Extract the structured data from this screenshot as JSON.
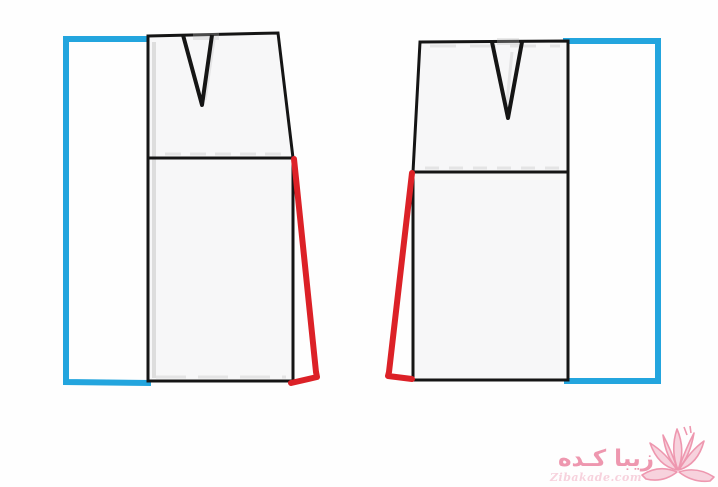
{
  "colors": {
    "background": "#fefefe",
    "outline_black": "#151515",
    "guide_blue": "#23a5de",
    "alteration_red": "#dc2127",
    "scan_shadow_gray": "#bdbdbd",
    "paper_fill": "#f7f7f8",
    "watermark_pink": "#ee97af",
    "watermark_pink_light": "#f7d2dd"
  },
  "watermark": {
    "brand_text_fa": "زیبا کـده",
    "brand_text_en": "Zibakade.com",
    "icon": "lotus-flower-icon"
  }
}
